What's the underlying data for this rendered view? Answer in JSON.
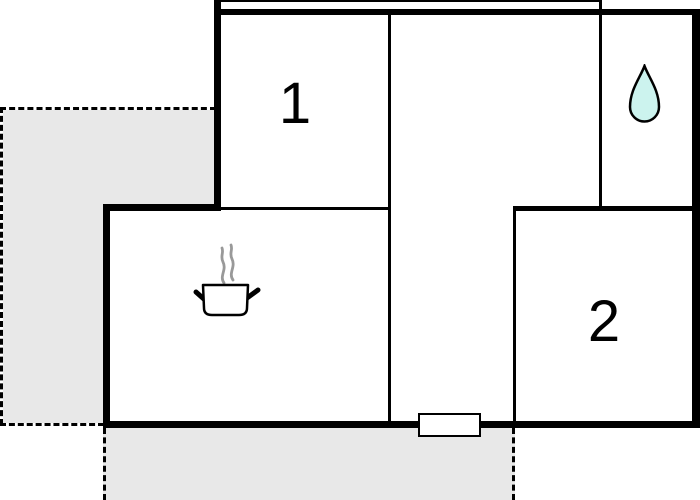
{
  "plan": {
    "rooms": [
      {
        "name": "room-1",
        "label": "1"
      },
      {
        "name": "room-2",
        "label": "2"
      }
    ],
    "icons": [
      {
        "name": "water-drop-icon"
      },
      {
        "name": "steaming-pot-icon"
      }
    ],
    "colors": {
      "background": "#ffffff",
      "wall": "#000000",
      "terrace_fill": "#e8e8e8",
      "drop_fill": "#ccf3ee",
      "drop_stroke": "#000000",
      "steam": "#999999",
      "door_fill": "#ffffff"
    }
  }
}
